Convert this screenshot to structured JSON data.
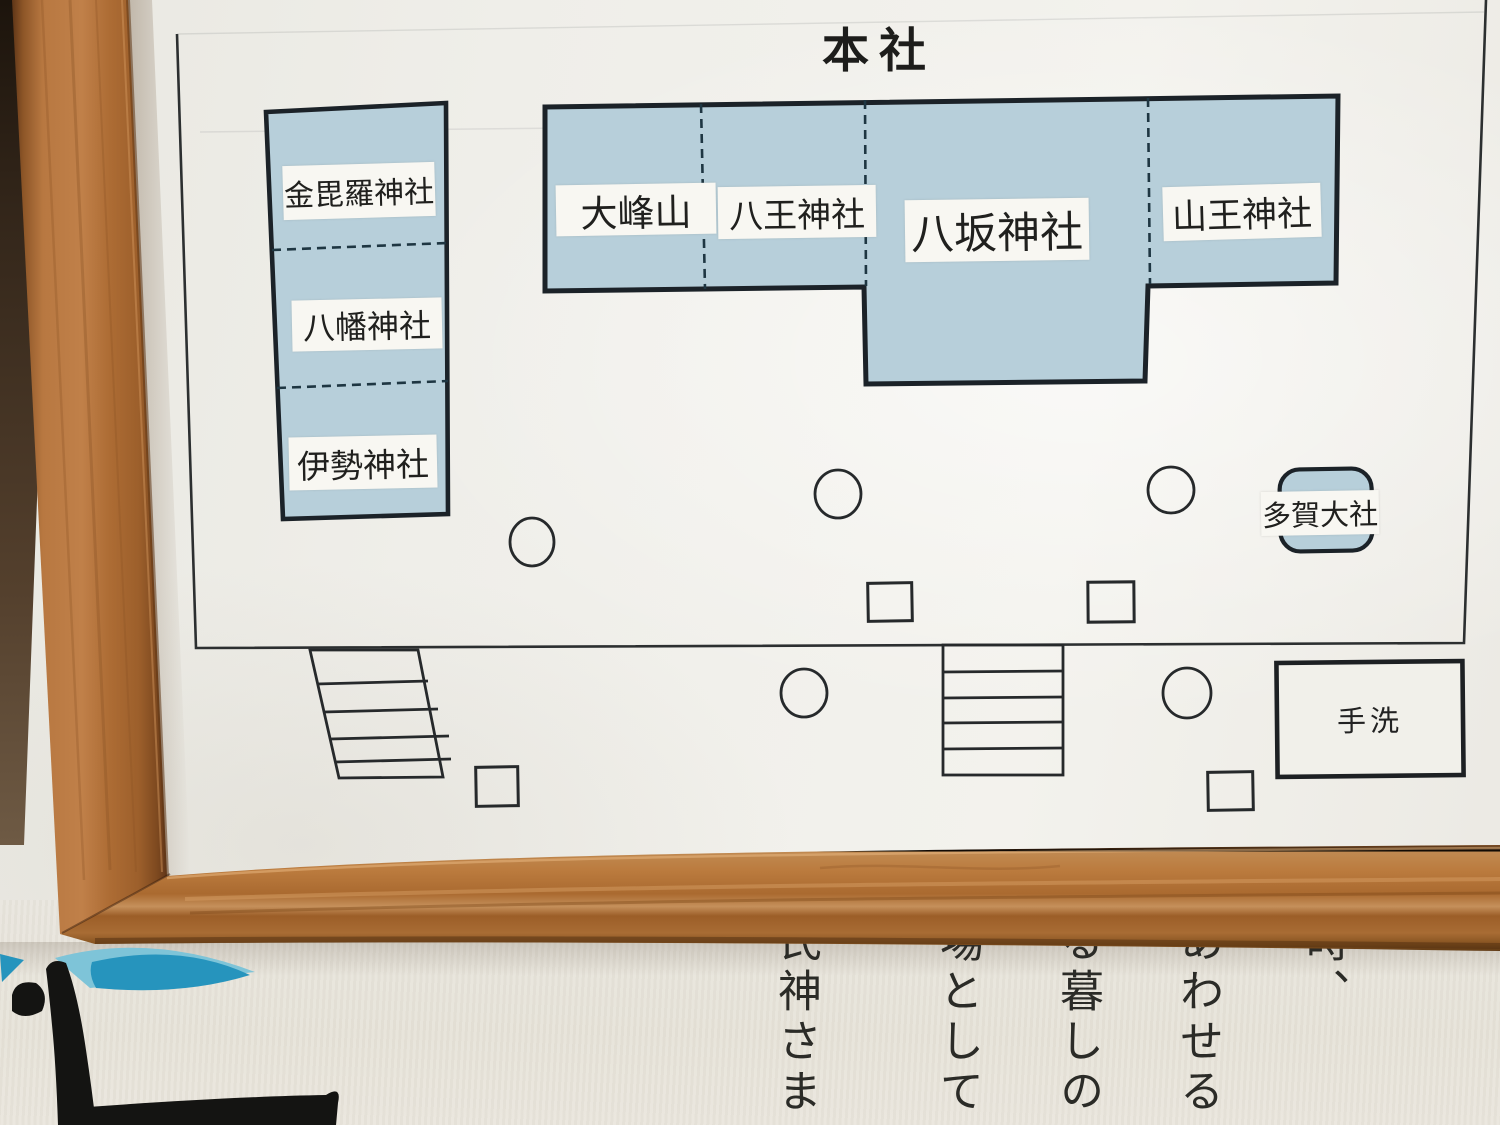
{
  "map": {
    "title": "本社",
    "west_shrines": [
      {
        "label": "金毘羅神社"
      },
      {
        "label": "八幡神社"
      },
      {
        "label": "伊勢神社"
      }
    ],
    "main_shrines": [
      {
        "label": "大峰山"
      },
      {
        "label": "八王神社"
      },
      {
        "label": "八坂神社"
      },
      {
        "label": "山王神社"
      }
    ],
    "taga_shrine_label": "多賀大社",
    "hand_wash_label": "手洗"
  },
  "poster": {
    "text_columns": [
      "時、",
      "あわせる",
      "る暮しの",
      "場として",
      "氏神さま"
    ]
  },
  "colors": {
    "building_fill": "#b7cfda",
    "outline": "#1b2228",
    "dashed_line": "#1e3642",
    "paper": "#efeee9",
    "label_white": "#f8f7f2",
    "frame_wood": "#b07038",
    "poster_bg": "#e8e4da",
    "poster_wave_blue": "#2694bd",
    "poster_wave_light_blue": "#7ec4d8",
    "ink_black": "#141412"
  }
}
